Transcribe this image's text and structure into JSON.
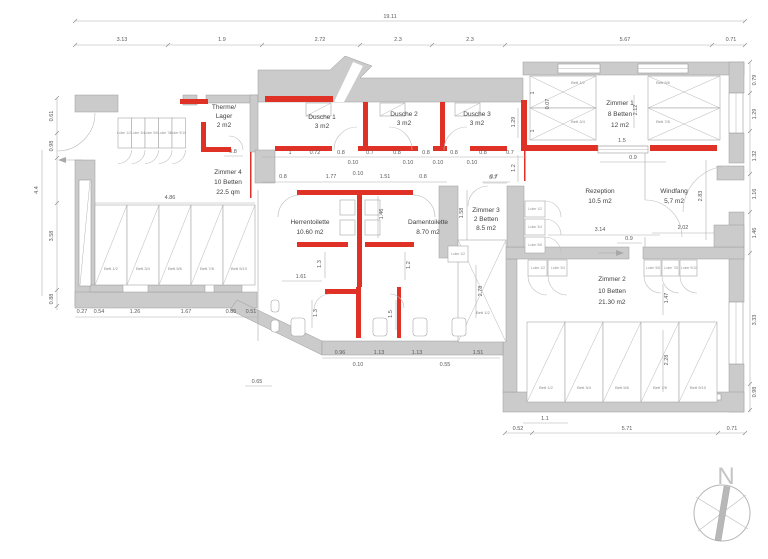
{
  "colors": {
    "wall": "#cbcbcb",
    "wall_stroke": "#9b9b9b",
    "highlight_red": "#e03127",
    "dim_text": "#5a5a5a"
  },
  "compass": {
    "label": "N"
  },
  "rooms": {
    "therme": {
      "l1": "Therme/",
      "l2": "Lager",
      "l3": "2 m2"
    },
    "dusche1": {
      "l1": "Dusche 1",
      "l2": "3 m2"
    },
    "dusche2": {
      "l1": "Dusche 2",
      "l2": "3 m2"
    },
    "dusche3": {
      "l1": "Dusche 3",
      "l2": "3 m2"
    },
    "zimmer1": {
      "l1": "Zimmer 1",
      "l2": "8 Betten",
      "l3": "12 m2"
    },
    "zimmer4": {
      "l1": "Zimmer 4",
      "l2": "10 Betten",
      "l3": "22.5 qm"
    },
    "herren": {
      "l1": "Herrentoilette",
      "l2": "10.60 m2"
    },
    "damen": {
      "l1": "Damentoilette",
      "l2": "8.70 m2"
    },
    "zimmer3": {
      "l1": "Zimmer 3",
      "l2": "2 Betten",
      "l3": "8.5 m2"
    },
    "rezeption": {
      "l1": "Rezeption",
      "l2": "10.5 m2"
    },
    "windfang": {
      "l1": "Windfang",
      "l2": "5,7 m2"
    },
    "zimmer2": {
      "l1": "Zimmer 2",
      "l2": "10 Betten",
      "l3": "21.30 m2"
    }
  },
  "beds": {
    "zimmer4": [
      "Bett 1/2",
      "Bett 3/4",
      "Bett 5/6",
      "Bett 7/8",
      "Bett 9/10"
    ],
    "zimmer2": [
      "Bett 1/2",
      "Bett 3/4",
      "Bett 5/6",
      "Bett 7/8",
      "Bett 9/10"
    ],
    "zimmer1": [
      "Bett 1/2",
      "Bett 3/4",
      "Bett 5/6",
      "Bett 7/8"
    ],
    "zimmer3": [
      "Bett 1/2"
    ]
  },
  "lockers": {
    "zimmer4": [
      "Loker 1/2",
      "Loker 3/4",
      "Loker 5/6",
      "Loker 7/8",
      "Loker 9/10"
    ],
    "flur": [
      "Loker 1/2",
      "Loker 3/4",
      "Loker 5/6"
    ],
    "flur2": [
      "Loker 1/2"
    ],
    "zimmer2_left": [
      "Loker 1/2",
      "Loker 3/4"
    ],
    "zimmer2_right": [
      "Loker 5/6",
      "Loker 7/8",
      "Loker 9/10"
    ]
  },
  "dims": {
    "total": "19.11",
    "top": [
      "3.13",
      "1.9",
      "2.72",
      "2.3",
      "2.3",
      "5.67",
      "0.71"
    ],
    "left": [
      "0.61",
      "0.98",
      "3.58",
      "0.88"
    ],
    "left_outer": "4.4",
    "left_bottom": [
      "0.27",
      "0.54",
      "1.26",
      "1.67",
      "0.85",
      "0.51"
    ],
    "right": [
      "0.79",
      "1.29",
      "1.32",
      "1.16",
      "1.46",
      "3.33",
      "0.98"
    ],
    "bottom_right": [
      "0.52",
      "5.71",
      "0.71"
    ],
    "inner11": "1.1",
    "bottom_mid": [
      "0.96",
      "1.13",
      "1.13",
      "1.51"
    ],
    "bottom_mid_sub": [
      "0.10",
      "0.55"
    ],
    "corridor": "0.65",
    "shower_row": [
      "1",
      "0.72",
      "0.8",
      "0.7",
      "0.8",
      "0.8",
      "0.8",
      "0.8",
      "0.7"
    ],
    "shower_sub": [
      "0.10",
      "0.10",
      "0.10",
      "0.10"
    ],
    "wc_row": [
      "0.8",
      "1.77",
      "0.10",
      "1.51",
      "0.8",
      "0.7"
    ],
    "therme_door": "0.8",
    "z4_w": "4.86",
    "z1_door": "1.5",
    "z1_sub": "0.9",
    "z1_v": [
      "1",
      "0.07",
      "1",
      "1.29",
      "1.2",
      "2.12"
    ],
    "rez_w": "3.14",
    "rez_sub": "0.9",
    "wf_w": "2.02",
    "wf_h": "2.83",
    "wc_h": "1.46",
    "z3_h": "1.58",
    "z3_top": "0.7",
    "wc_left": "1.61",
    "wc_v": [
      "1.3",
      "1.2",
      "1.3",
      "1.5"
    ],
    "bed3_h": "2.78",
    "z2_v": [
      "1.47",
      "2.28"
    ]
  }
}
